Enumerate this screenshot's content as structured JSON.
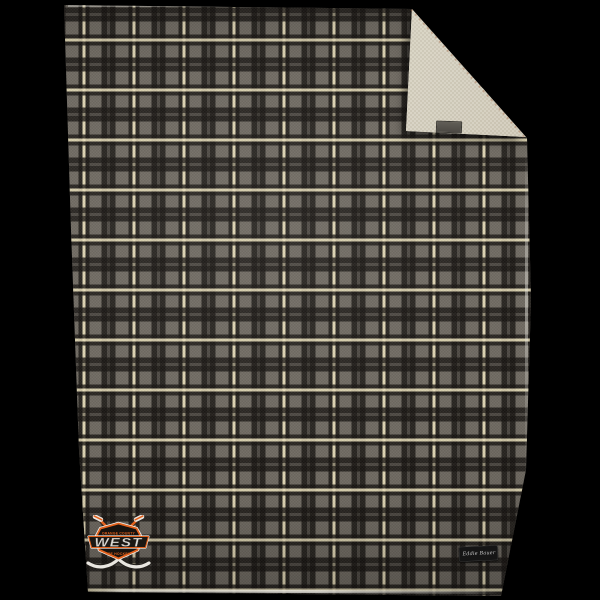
{
  "scene": {
    "background_color": "#000000"
  },
  "blanket": {
    "front": {
      "base_color": "#6e6961",
      "dark_stripe_color": "#2e2a26",
      "cream_stripe_color": "#ddd3b0",
      "plaid_repeat_px": 50
    },
    "lining": {
      "color": "#d7d2c3"
    }
  },
  "logo": {
    "top_text": "ORANGE COUNTY",
    "main_text": "WEST",
    "bottom_text": "ICE HOCKEY",
    "accent_color": "#e2611c",
    "badge_color": "#17130f",
    "stick_color": "#e9e6e0"
  },
  "brand_tag": {
    "label": "Eddie Bauer",
    "background_color": "#151515",
    "text_color": "#c9c9c9"
  },
  "fold_tag": {
    "background_color": "#4c4944"
  }
}
